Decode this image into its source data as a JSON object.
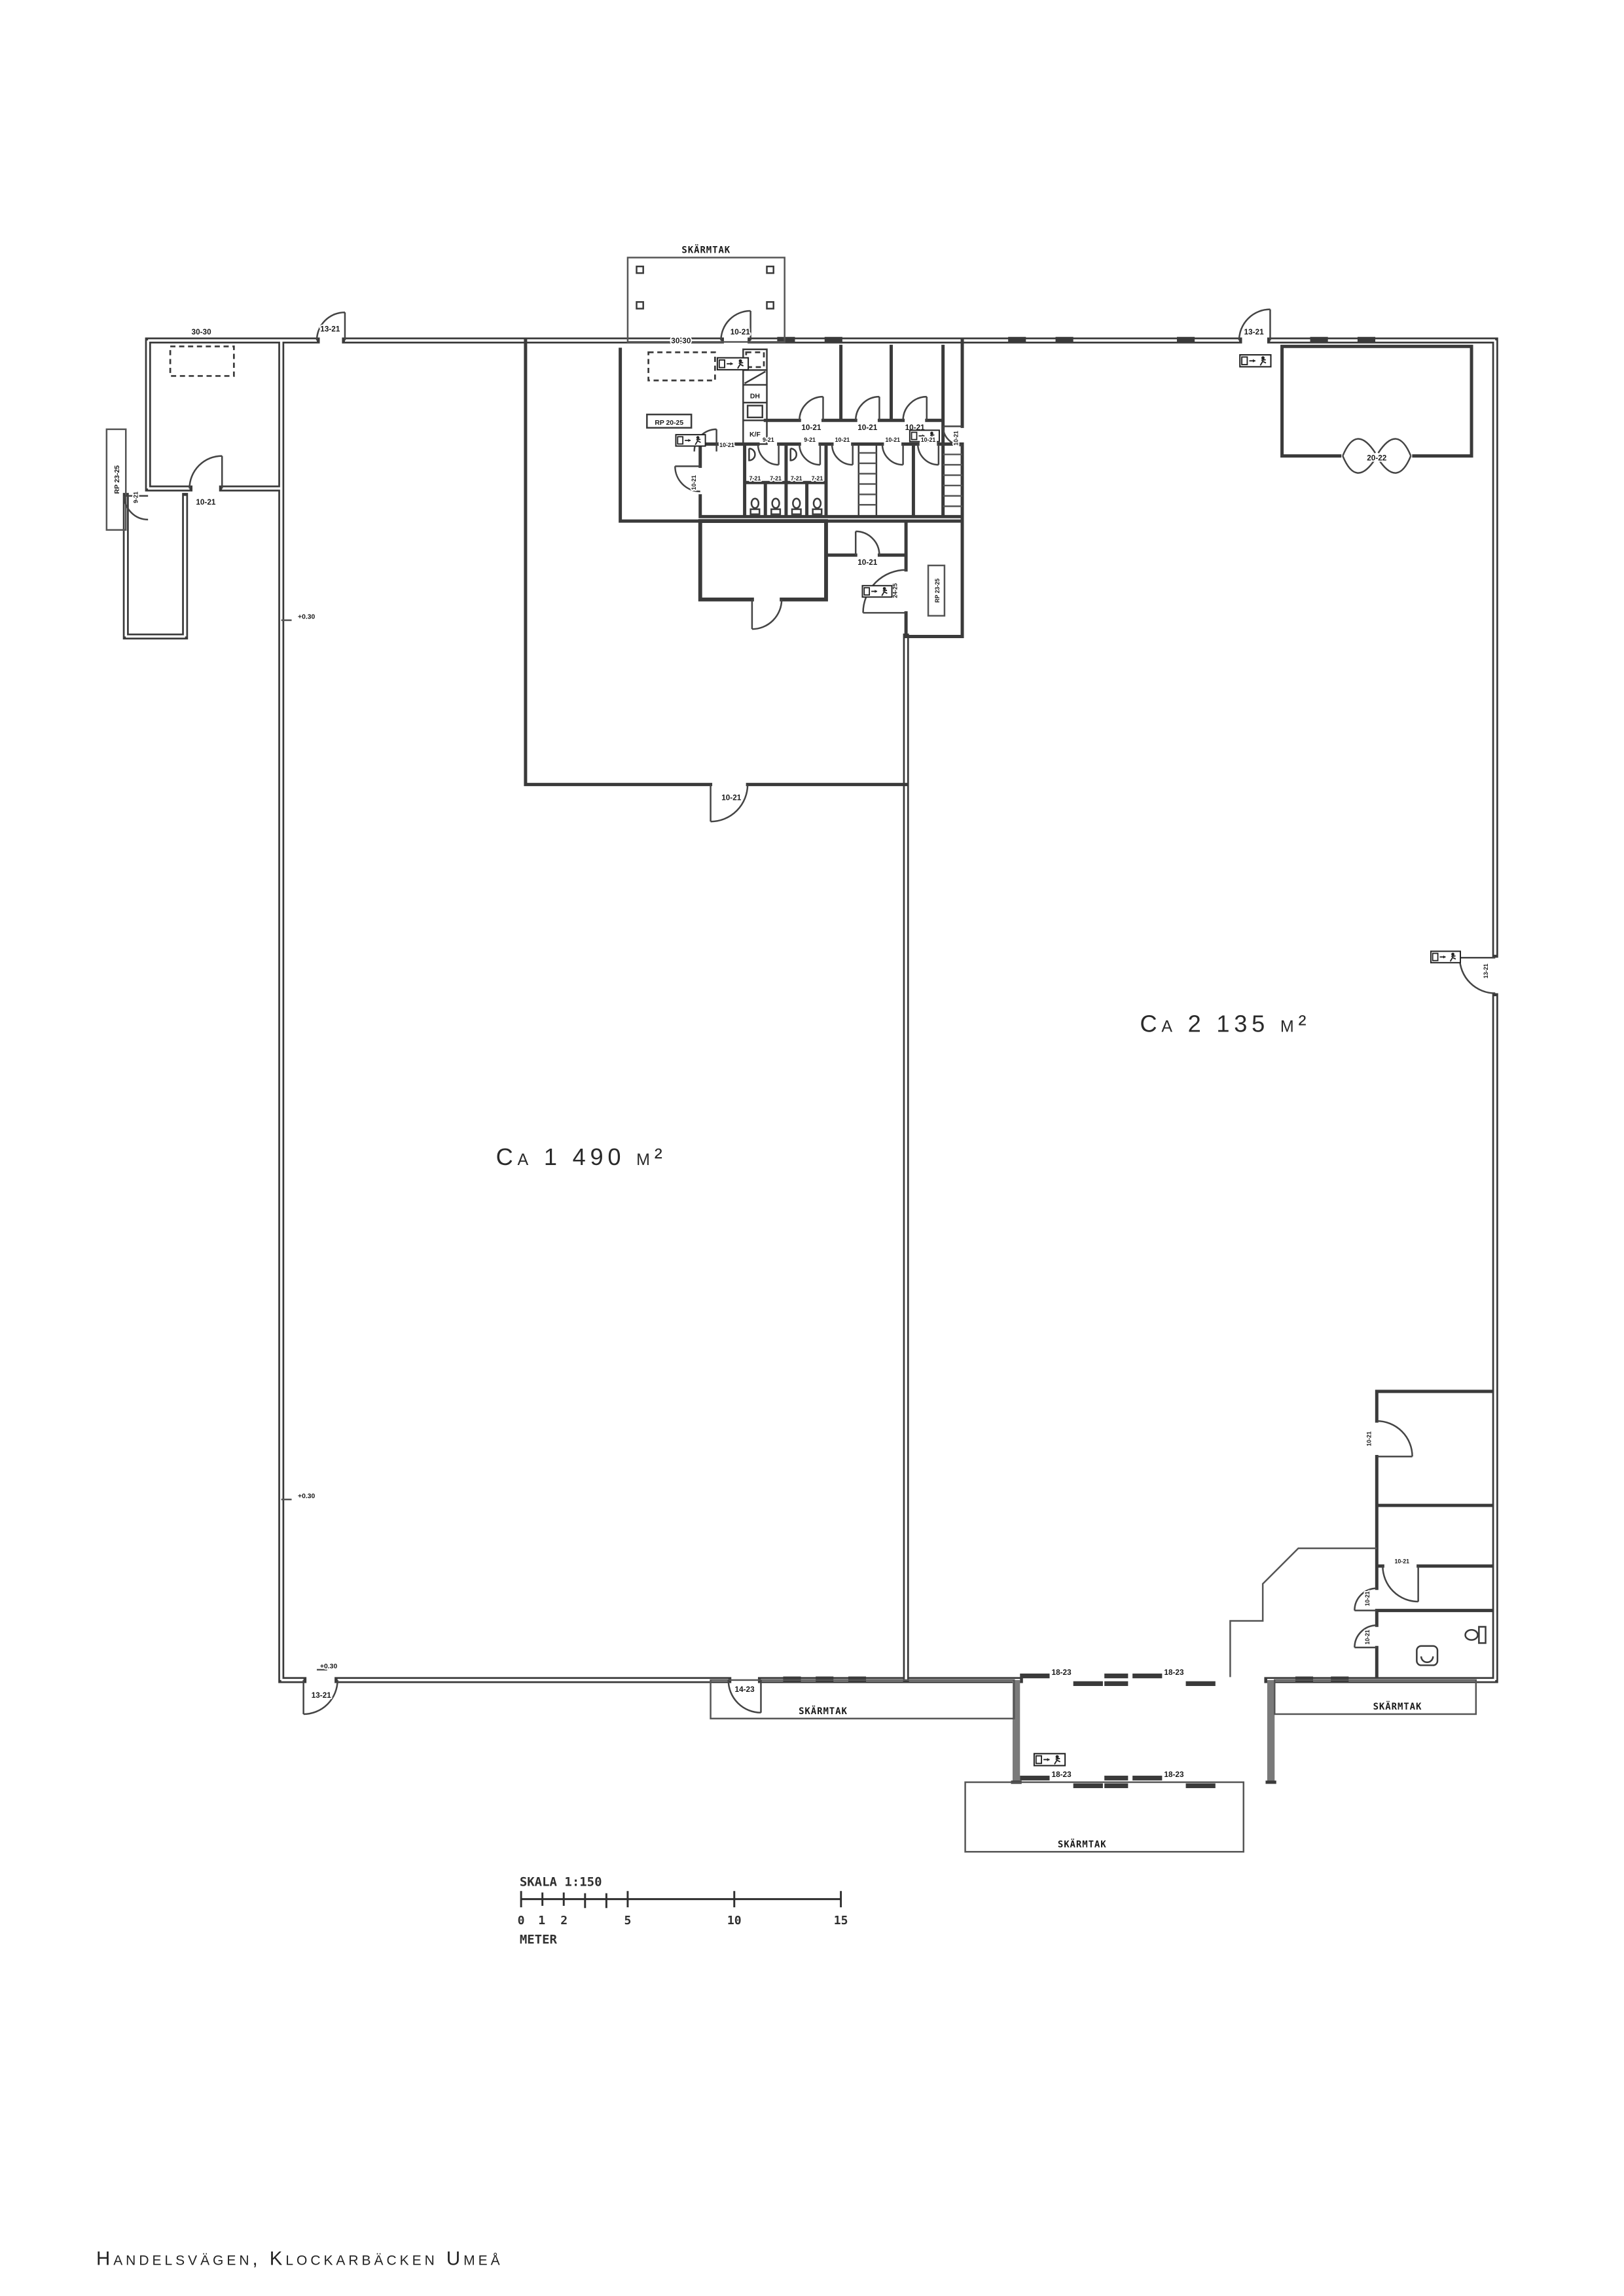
{
  "footer": {
    "address": "Handelsvägen, Klockarbäcken Umeå"
  },
  "areas": {
    "left": "Ca 1 490 m²",
    "right": "Ca 2 135 m²"
  },
  "scale_bar": {
    "title": "SKALA 1:150",
    "unit": "METER",
    "t0": "0",
    "t1": "1",
    "t2": "2",
    "t5": "5",
    "t10": "10",
    "t15": "15"
  },
  "canopy": {
    "top": "SKÄRMTAK",
    "bottom_left": "SKÄRMTAK",
    "bottom_right": "SKÄRMTAK",
    "vestibule": "SKÄRMTAK"
  },
  "levels": {
    "upper": "+0.30",
    "lower": "+0.30",
    "corner": "+0.30"
  },
  "docks": {
    "left": "30-30",
    "office": "30-30"
  },
  "ramps": {
    "left": "RP 23-25",
    "office": "RP 20-25",
    "corridor": "RP 23-25"
  },
  "pentry": {
    "dh": "DH",
    "kf": "K/F"
  },
  "doors": {
    "top_left": "13-21",
    "protrusion_h": "10-21",
    "protrusion_v": "9-21",
    "entrance": "10-21",
    "top_right": "13-21",
    "storage_double": "20-22",
    "office_a": "10-21",
    "office_b": "10-21",
    "office_c": "10-21",
    "corridor_east": "10-21",
    "wc_1": "9-21",
    "wc_2": "9-21",
    "wc_3": "10-21",
    "wc_4": "10-21",
    "wc_5": "10-21",
    "stall_1": "7-21",
    "stall_2": "7-21",
    "stall_3": "7-21",
    "stall_4": "7-21",
    "wc_room_west": "10-21",
    "lobby": "10-21",
    "corridor_mid": "10-21",
    "room_2425": "24-25",
    "hall_join": "10-21",
    "right_wall": "13-21",
    "strip_1": "10-21",
    "strip_2": "10-21",
    "strip_3": "10-21",
    "strip_4": "10-21",
    "slide_top_1": "18-23",
    "slide_top_2": "18-23",
    "slide_bottom_1": "18-23",
    "slide_bottom_2": "18-23",
    "bottom_corner": "13-21",
    "bottom_canopy": "14-23"
  }
}
